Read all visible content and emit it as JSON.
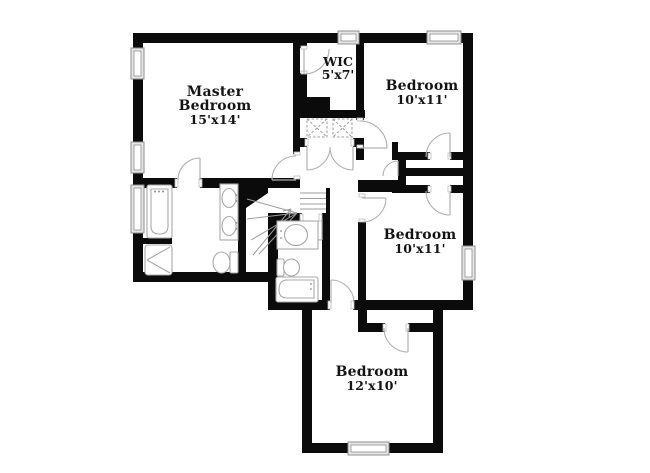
{
  "plan": {
    "type": "floor-plan",
    "rooms": {
      "master_bedroom": {
        "name_line1": "Master",
        "name_line2": "Bedroom",
        "dimensions": "15'x14'"
      },
      "wic": {
        "name": "WIC",
        "dimensions": "5'x7'"
      },
      "bedroom_top_right": {
        "name": "Bedroom",
        "dimensions": "10'x11'"
      },
      "bedroom_middle_right": {
        "name": "Bedroom",
        "dimensions": "10'x11'"
      },
      "bedroom_bottom": {
        "name": "Bedroom",
        "dimensions": "12'x10'"
      }
    },
    "fixtures": {
      "master_bathroom": [
        "bathtub",
        "shower",
        "double-sink-vanity",
        "toilet"
      ],
      "hall_bathroom": [
        "sink-vanity",
        "toilet",
        "bathtub"
      ],
      "hall": [
        "staircase",
        "utility-closet"
      ],
      "window_count": 7
    },
    "colors": {
      "wall": "#0b0b0b",
      "fixture_outline": "#a8a8a8",
      "window_frame": "#8f8f8f",
      "label_text": "#141414",
      "background": "#ffffff"
    }
  }
}
